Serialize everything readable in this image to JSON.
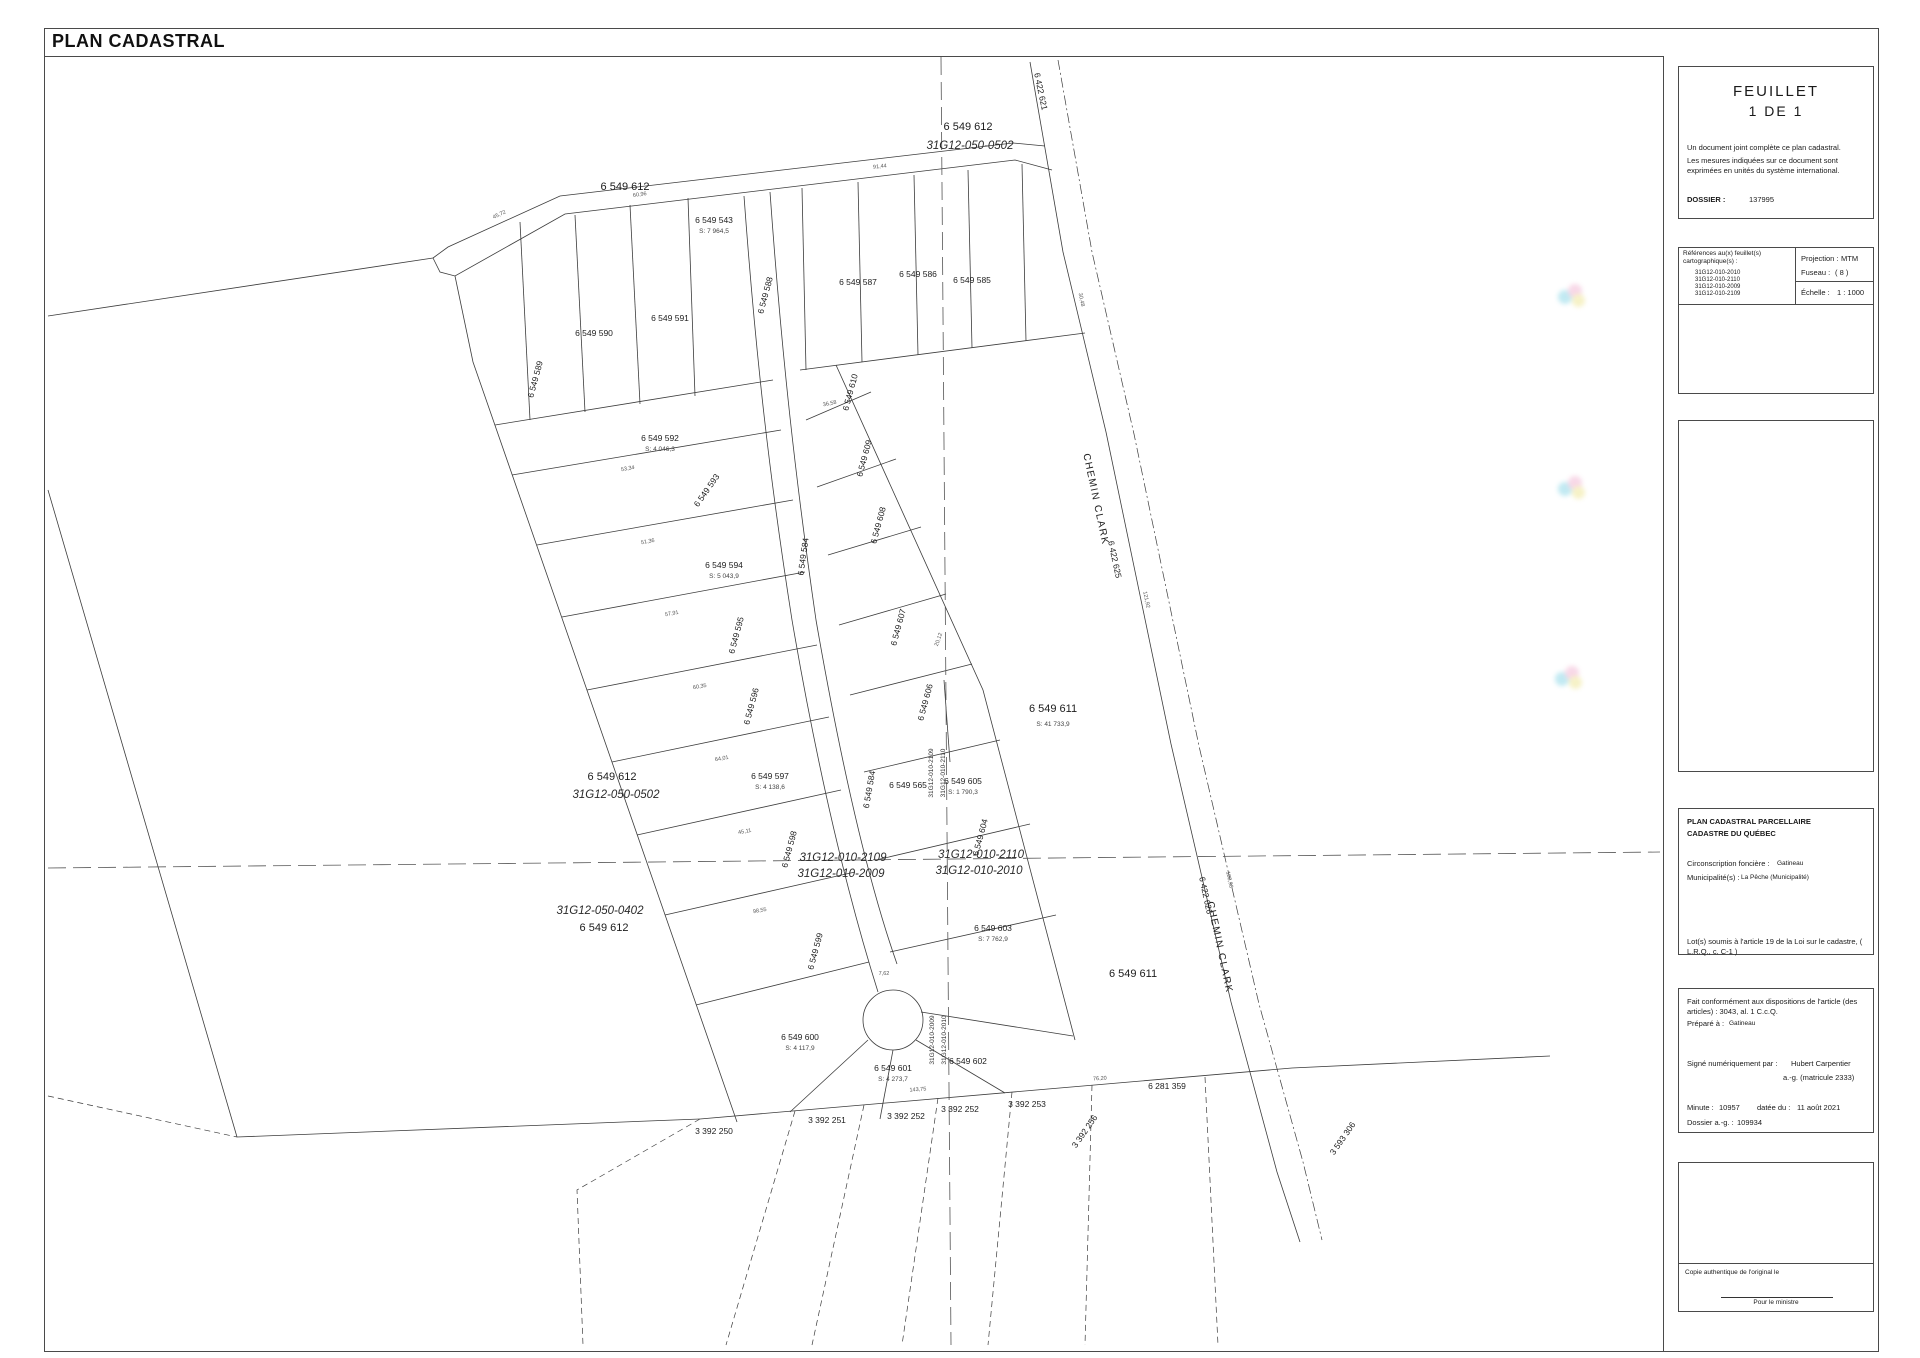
{
  "title": "PLAN CADASTRAL",
  "panel": {
    "feuillet": {
      "word": "FEUILLET",
      "number": "1 DE 1",
      "note1": "Un document joint complète ce plan cadastral.",
      "note2": "Les mesures indiquées sur ce document sont exprimées en unités du système international.",
      "dossier_label": "DOSSIER :",
      "dossier_value": "137995"
    },
    "references": {
      "header": "Références au(x) feuillet(s) cartographique(s) :",
      "sheet1": "31G12-010-2010",
      "sheet2": "31G12-010-2110",
      "sheet3": "31G12-010-2009",
      "sheet4": "31G12-010-2109",
      "projection_label": "Projection :",
      "projection_value": "MTM",
      "fuseau_label": "Fuseau :",
      "fuseau_value": "( 8 )",
      "echelle_label": "Échelle :",
      "echelle_value": "1 : 1000"
    },
    "cadastre": {
      "title1": "PLAN CADASTRAL PARCELLAIRE",
      "title2": "CADASTRE DU QUÉBEC",
      "circ_label": "Circonscription foncière :",
      "circ_value": "Gatineau",
      "mun_label": "Municipalité(s) :",
      "mun_value": "La Pêche (Municipalité)",
      "note": "Lot(s) soumis à l'article 19 de la Loi sur le cadastre, ( L.R.Q., c. C-1 )"
    },
    "certification": {
      "line1": "Fait conformément aux dispositions de l'article (des articles) :  3043, al. 1 C.c.Q.",
      "prepare_label": "Préparé à :",
      "prepare_value": "Gatineau",
      "signe_label": "Signé numériquement par :",
      "signe_name": "Hubert  Carpentier",
      "signe_title": "a.-g. (matricule 2333)",
      "minute_label": "Minute :",
      "minute_value": "10957",
      "date_label": "datée du :",
      "date_value": "11 août 2021",
      "dossier_ag_label": "Dossier a.-g. :",
      "dossier_ag_value": "109934"
    },
    "copy": {
      "note": "Copie authentique de l'original le",
      "ministre": "Pour le ministre"
    }
  },
  "map": {
    "labels": [
      {
        "t": "6 422 621",
        "x": 1038,
        "y": 92,
        "r": 78,
        "c": "lot-sm"
      },
      {
        "t": "6 549 612",
        "x": 968,
        "y": 130,
        "c": "lot"
      },
      {
        "t": "31G12-050-0502",
        "x": 970,
        "y": 149,
        "c": "sheet"
      },
      {
        "t": "6 549 612",
        "x": 625,
        "y": 190,
        "c": "lot"
      },
      {
        "t": "6 549 543",
        "x": 714,
        "y": 223,
        "c": "lot-sm"
      },
      {
        "t": "S: 7 964,5",
        "x": 714,
        "y": 233,
        "c": "area"
      },
      {
        "t": "6 549 589",
        "x": 538,
        "y": 380,
        "r": -75,
        "c": "lot-sm"
      },
      {
        "t": "6 549 590",
        "x": 594,
        "y": 336,
        "c": "lot-sm"
      },
      {
        "t": "6 549 591",
        "x": 670,
        "y": 321,
        "c": "lot-sm"
      },
      {
        "t": "6 549 588",
        "x": 768,
        "y": 296,
        "r": -75,
        "c": "lot-sm"
      },
      {
        "t": "6 549 587",
        "x": 858,
        "y": 285,
        "c": "lot-sm"
      },
      {
        "t": "6 549 586",
        "x": 918,
        "y": 277,
        "c": "lot-sm"
      },
      {
        "t": "6 549 585",
        "x": 972,
        "y": 283,
        "c": "lot-sm"
      },
      {
        "t": "6 549 592",
        "x": 660,
        "y": 441,
        "c": "lot-sm"
      },
      {
        "t": "S: 4 046,3",
        "x": 660,
        "y": 451,
        "c": "area"
      },
      {
        "t": "6 549 593",
        "x": 709,
        "y": 492,
        "r": -55,
        "c": "lot-sm"
      },
      {
        "t": "6 549 594",
        "x": 724,
        "y": 568,
        "c": "lot-sm"
      },
      {
        "t": "S: 5 043,9",
        "x": 724,
        "y": 578,
        "c": "area"
      },
      {
        "t": "6 549 595",
        "x": 739,
        "y": 636,
        "r": -75,
        "c": "lot-sm"
      },
      {
        "t": "6 549 596",
        "x": 754,
        "y": 707,
        "r": -75,
        "c": "lot-sm"
      },
      {
        "t": "6 549 597",
        "x": 770,
        "y": 779,
        "c": "lot-sm"
      },
      {
        "t": "S: 4 138,6",
        "x": 770,
        "y": 789,
        "c": "area"
      },
      {
        "t": "6 549 598",
        "x": 792,
        "y": 850,
        "r": -75,
        "c": "lot-sm"
      },
      {
        "t": "6 549 599",
        "x": 818,
        "y": 952,
        "r": -75,
        "c": "lot-sm"
      },
      {
        "t": "6 549 600",
        "x": 800,
        "y": 1040,
        "c": "lot-sm"
      },
      {
        "t": "S: 4 117,9",
        "x": 800,
        "y": 1050,
        "c": "area"
      },
      {
        "t": "6 549 601",
        "x": 893,
        "y": 1071,
        "c": "lot-sm"
      },
      {
        "t": "S: 4 273,7",
        "x": 893,
        "y": 1081,
        "c": "area"
      },
      {
        "t": "6 549 602",
        "x": 968,
        "y": 1064,
        "c": "lot-sm"
      },
      {
        "t": "6 549 610",
        "x": 853,
        "y": 393,
        "r": -75,
        "c": "lot-sm"
      },
      {
        "t": "6 549 609",
        "x": 867,
        "y": 459,
        "r": -75,
        "c": "lot-sm"
      },
      {
        "t": "6 549 608",
        "x": 881,
        "y": 526,
        "r": -75,
        "c": "lot-sm"
      },
      {
        "t": "6 549 607",
        "x": 901,
        "y": 628,
        "r": -75,
        "c": "lot-sm"
      },
      {
        "t": "6 549 606",
        "x": 928,
        "y": 703,
        "r": -75,
        "c": "lot-sm"
      },
      {
        "t": "6 549 565",
        "x": 908,
        "y": 788,
        "c": "lot-sm"
      },
      {
        "t": "6 549 605",
        "x": 963,
        "y": 784,
        "c": "lot-sm"
      },
      {
        "t": "S: 1 790,3",
        "x": 963,
        "y": 794,
        "c": "area"
      },
      {
        "t": "6 549 604",
        "x": 983,
        "y": 838,
        "r": -75,
        "c": "lot-sm"
      },
      {
        "t": "6 549 603",
        "x": 993,
        "y": 931,
        "c": "lot-sm"
      },
      {
        "t": "S: 7 762,9",
        "x": 993,
        "y": 941,
        "c": "area"
      },
      {
        "t": "6 549 611",
        "x": 1053,
        "y": 712,
        "c": "lot"
      },
      {
        "t": "S: 41 733,9",
        "x": 1053,
        "y": 726,
        "c": "area"
      },
      {
        "t": "6 549 611",
        "x": 1133,
        "y": 977,
        "c": "lot"
      },
      {
        "t": "6 549 584",
        "x": 806,
        "y": 557,
        "r": -82,
        "c": "lot-sm"
      },
      {
        "t": "6 549 584",
        "x": 872,
        "y": 790,
        "r": -80,
        "c": "lot-sm"
      },
      {
        "t": "CHEMIN CLARK",
        "x": 1093,
        "y": 500,
        "r": 78,
        "c": "road"
      },
      {
        "t": "6 422 625",
        "x": 1112,
        "y": 560,
        "r": 78,
        "c": "lot-sm"
      },
      {
        "t": "6 422 626",
        "x": 1203,
        "y": 896,
        "r": 78,
        "c": "lot-sm"
      },
      {
        "t": "CHEMIN CLARK",
        "x": 1217,
        "y": 948,
        "r": 78,
        "c": "road"
      },
      {
        "t": "6 549 612",
        "x": 612,
        "y": 780,
        "c": "lot"
      },
      {
        "t": "31G12-050-0502",
        "x": 616,
        "y": 798,
        "c": "sheet"
      },
      {
        "t": "31G12-050-0402",
        "x": 600,
        "y": 914,
        "c": "sheet"
      },
      {
        "t": "6 549 612",
        "x": 604,
        "y": 931,
        "c": "lot"
      },
      {
        "t": "31G12-010-2109",
        "x": 843,
        "y": 861,
        "c": "sheet"
      },
      {
        "t": "31G12-010-2009",
        "x": 841,
        "y": 877,
        "c": "sheet"
      },
      {
        "t": "31G12-010-2110",
        "x": 981,
        "y": 858,
        "c": "sheet"
      },
      {
        "t": "31G12-010-2010",
        "x": 979,
        "y": 874,
        "c": "sheet"
      },
      {
        "t": "31G12-010-2109",
        "x": 933,
        "y": 773,
        "r": -90,
        "c": "vsheet"
      },
      {
        "t": "31G12-010-2110",
        "x": 945,
        "y": 773,
        "r": -90,
        "c": "vsheet"
      },
      {
        "t": "31G12-010-2009",
        "x": 934,
        "y": 1040,
        "r": -90,
        "c": "vsheet"
      },
      {
        "t": "31G12-010-2010",
        "x": 946,
        "y": 1040,
        "r": -90,
        "c": "vsheet"
      },
      {
        "t": "3 392 250",
        "x": 714,
        "y": 1134,
        "c": "lot-sm"
      },
      {
        "t": "3 392 251",
        "x": 827,
        "y": 1123,
        "c": "lot-sm"
      },
      {
        "t": "3 392 252",
        "x": 906,
        "y": 1119,
        "c": "lot-sm"
      },
      {
        "t": "3 392 252",
        "x": 960,
        "y": 1112,
        "c": "lot-sm"
      },
      {
        "t": "3 392 253",
        "x": 1027,
        "y": 1107,
        "c": "lot-sm"
      },
      {
        "t": "3 392 256",
        "x": 1087,
        "y": 1133,
        "r": -55,
        "c": "lot-sm"
      },
      {
        "t": "3 593 306",
        "x": 1345,
        "y": 1140,
        "r": -55,
        "c": "lot-sm"
      },
      {
        "t": "6 281 359",
        "x": 1167,
        "y": 1089,
        "c": "lot-sm"
      },
      {
        "t": "45,72",
        "x": 500,
        "y": 216,
        "r": -26,
        "c": "dim"
      },
      {
        "t": "60,96",
        "x": 640,
        "y": 196,
        "r": -8,
        "c": "dim"
      },
      {
        "t": "91,44",
        "x": 880,
        "y": 168,
        "r": -6,
        "c": "dim"
      },
      {
        "t": "53,34",
        "x": 628,
        "y": 470,
        "r": -10,
        "c": "dim"
      },
      {
        "t": "51,36",
        "x": 648,
        "y": 543,
        "r": -10,
        "c": "dim"
      },
      {
        "t": "57,91",
        "x": 672,
        "y": 615,
        "r": -10,
        "c": "dim"
      },
      {
        "t": "60,35",
        "x": 700,
        "y": 688,
        "r": -10,
        "c": "dim"
      },
      {
        "t": "64,01",
        "x": 722,
        "y": 760,
        "r": -10,
        "c": "dim"
      },
      {
        "t": "45,11",
        "x": 745,
        "y": 833,
        "r": -10,
        "c": "dim"
      },
      {
        "t": "98,55",
        "x": 760,
        "y": 912,
        "r": -10,
        "c": "dim"
      },
      {
        "t": "36,58",
        "x": 830,
        "y": 405,
        "r": -12,
        "c": "dim"
      },
      {
        "t": "20,12",
        "x": 940,
        "y": 640,
        "r": -70,
        "c": "dim"
      },
      {
        "t": "30,48",
        "x": 1080,
        "y": 300,
        "r": 78,
        "c": "dim"
      },
      {
        "t": "121,92",
        "x": 1145,
        "y": 600,
        "r": 78,
        "c": "dim"
      },
      {
        "t": "188,98",
        "x": 1228,
        "y": 880,
        "r": 78,
        "c": "dim"
      },
      {
        "t": "143,75",
        "x": 918,
        "y": 1091,
        "r": -4,
        "c": "dim"
      },
      {
        "t": "76,20",
        "x": 1100,
        "y": 1080,
        "r": -4,
        "c": "dim"
      },
      {
        "t": "7,62",
        "x": 884,
        "y": 975,
        "r": 0,
        "c": "dim"
      }
    ]
  }
}
